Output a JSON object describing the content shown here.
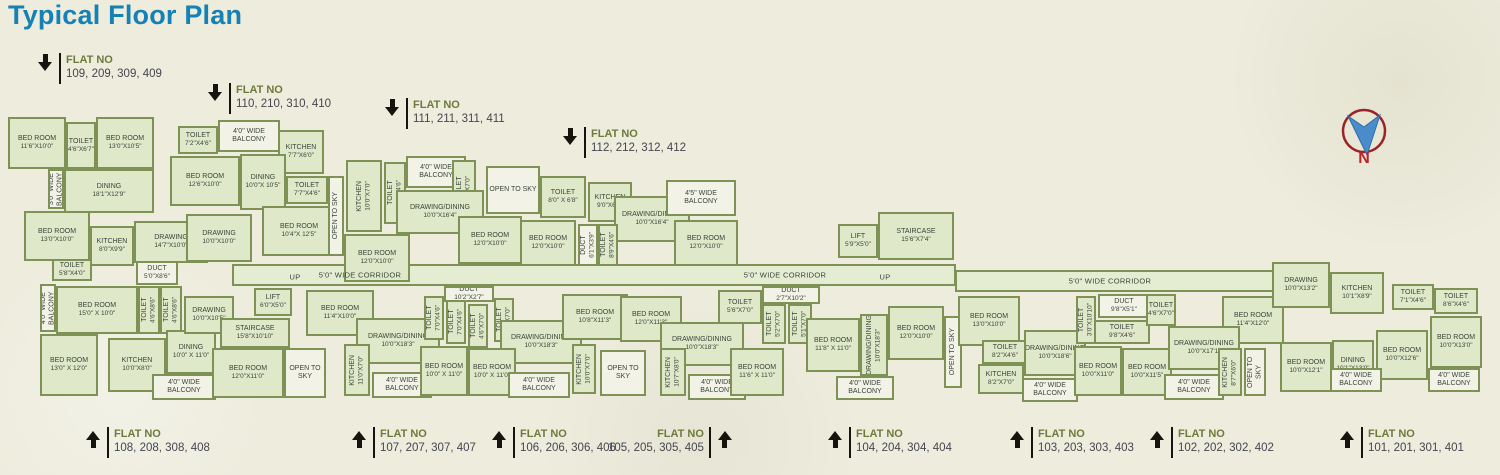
{
  "title": "Typical Floor Plan",
  "compass": {
    "north_label": "N"
  },
  "colors": {
    "title": "#1581b4",
    "wall": "#7e9255",
    "room_fill": "#dfe8c9",
    "light_fill": "#f3f2e6",
    "flat_no_text": "#6d7b3c",
    "flat_numbers_text": "#45464f",
    "compass_ring": "#9b2226",
    "compass_needle": "#4a8ccb",
    "compass_n": "#b9252b"
  },
  "flat_labels": {
    "heading": "FLAT NO",
    "top": [
      {
        "x": 38,
        "y": 53,
        "numbers": "109, 209, 309, 409"
      },
      {
        "x": 208,
        "y": 83,
        "numbers": "110, 210, 310, 410"
      },
      {
        "x": 385,
        "y": 98,
        "numbers": "111, 211, 311, 411"
      },
      {
        "x": 563,
        "y": 127,
        "numbers": "112, 212, 312, 412"
      }
    ],
    "bottom": [
      {
        "x": 86,
        "y": 427,
        "numbers": "108, 208, 308, 408"
      },
      {
        "x": 352,
        "y": 427,
        "numbers": "107, 207, 307, 407"
      },
      {
        "x": 492,
        "y": 427,
        "numbers": "106, 206, 306, 406"
      },
      {
        "x": 608,
        "y": 427,
        "numbers": "105, 205, 305, 405",
        "mirror": true
      },
      {
        "x": 828,
        "y": 427,
        "numbers": "104, 204, 304, 404"
      },
      {
        "x": 1010,
        "y": 427,
        "numbers": "103, 203, 303, 403"
      },
      {
        "x": 1150,
        "y": 427,
        "numbers": "102, 202, 302, 402"
      },
      {
        "x": 1340,
        "y": 427,
        "numbers": "101, 201, 301, 401"
      }
    ]
  },
  "plan": {
    "corridors": [
      {
        "x": 232,
        "y": 264,
        "w": 724,
        "h": 22
      },
      {
        "x": 955,
        "y": 270,
        "w": 320,
        "h": 22
      }
    ],
    "float_labels": [
      {
        "x": 360,
        "y": 275,
        "text": "5'0\" WIDE CORRIDOR"
      },
      {
        "x": 785,
        "y": 275,
        "text": "5'0\" WIDE CORRIDOR"
      },
      {
        "x": 1110,
        "y": 281,
        "text": "5'0\" WIDE CORRIDOR"
      },
      {
        "x": 295,
        "y": 277,
        "text": "UP"
      },
      {
        "x": 885,
        "y": 277,
        "text": "UP"
      }
    ],
    "rooms": [
      {
        "x": 8,
        "y": 117,
        "w": 58,
        "h": 52,
        "n": "BED ROOM",
        "d": "11'6\"X10'0\""
      },
      {
        "x": 66,
        "y": 122,
        "w": 30,
        "h": 47,
        "n": "TOILET",
        "d": "4'6\"X6'7\""
      },
      {
        "x": 96,
        "y": 117,
        "w": 58,
        "h": 52,
        "n": "BED ROOM",
        "d": "13'0\"X10'5\""
      },
      {
        "x": 48,
        "y": 169,
        "w": 16,
        "h": 40,
        "n": "3'0\" WIDE BALCONY",
        "v": true,
        "f": "w"
      },
      {
        "x": 64,
        "y": 169,
        "w": 90,
        "h": 44,
        "n": "DINING",
        "d": "18'1\"X12'9\""
      },
      {
        "x": 24,
        "y": 211,
        "w": 66,
        "h": 50,
        "n": "BED ROOM",
        "d": "13'0\"X10'0\""
      },
      {
        "x": 90,
        "y": 226,
        "w": 44,
        "h": 40,
        "n": "KITCHEN",
        "d": "8'0\"X9'9\""
      },
      {
        "x": 52,
        "y": 259,
        "w": 40,
        "h": 22,
        "n": "TOILET",
        "d": "5'8\"X4'0\""
      },
      {
        "x": 134,
        "y": 221,
        "w": 74,
        "h": 42,
        "n": "DRAWING",
        "d": "14'7\"X10'0\""
      },
      {
        "x": 136,
        "y": 261,
        "w": 42,
        "h": 24,
        "n": "DUCT",
        "d": "5'0\"X8'6\"",
        "f": "w"
      },
      {
        "x": 178,
        "y": 126,
        "w": 40,
        "h": 28,
        "n": "TOILET",
        "d": "7'2\"X4'6\""
      },
      {
        "x": 218,
        "y": 120,
        "w": 62,
        "h": 32,
        "n": "4'0\" WIDE BALCONY",
        "f": "w"
      },
      {
        "x": 278,
        "y": 130,
        "w": 46,
        "h": 44,
        "n": "KITCHEN",
        "d": "7'7\"X6'0\""
      },
      {
        "x": 170,
        "y": 156,
        "w": 70,
        "h": 50,
        "n": "BED ROOM",
        "d": "12'6\"X10'0\""
      },
      {
        "x": 240,
        "y": 154,
        "w": 46,
        "h": 56,
        "n": "DINING",
        "d": "10'0\"X 10'5\""
      },
      {
        "x": 286,
        "y": 176,
        "w": 42,
        "h": 28,
        "n": "TOILET",
        "d": "7'7\"X4'6\""
      },
      {
        "x": 262,
        "y": 206,
        "w": 74,
        "h": 50,
        "n": "BED ROOM",
        "d": "10'4\"X 12'5\""
      },
      {
        "x": 186,
        "y": 214,
        "w": 66,
        "h": 48,
        "n": "DRAWING",
        "d": "10'0\"X10'0\""
      },
      {
        "x": 328,
        "y": 176,
        "w": 16,
        "h": 80,
        "n": "OPEN TO SKY",
        "v": true,
        "f": "w"
      },
      {
        "x": 346,
        "y": 160,
        "w": 36,
        "h": 72,
        "n": "KITCHEN",
        "d": "10'0\"X7'0\"",
        "v": true
      },
      {
        "x": 384,
        "y": 162,
        "w": 22,
        "h": 62,
        "n": "TOILET",
        "d": "7'0\"X4'6\"",
        "v": true
      },
      {
        "x": 406,
        "y": 156,
        "w": 60,
        "h": 32,
        "n": "4'0\" WIDE BALCONY",
        "f": "w"
      },
      {
        "x": 452,
        "y": 160,
        "w": 24,
        "h": 58,
        "n": "TOILET",
        "d": "4'7\"X7'0\"",
        "v": true
      },
      {
        "x": 396,
        "y": 190,
        "w": 88,
        "h": 44,
        "n": "DRAWING/DINING",
        "d": "10'0\"X16'4\""
      },
      {
        "x": 344,
        "y": 234,
        "w": 66,
        "h": 48,
        "n": "BED ROOM",
        "d": "12'0\"X10'0\""
      },
      {
        "x": 458,
        "y": 216,
        "w": 64,
        "h": 48,
        "n": "BED ROOM",
        "d": "12'0\"X10'0\""
      },
      {
        "x": 486,
        "y": 166,
        "w": 54,
        "h": 48,
        "n": "OPEN TO SKY",
        "f": "w"
      },
      {
        "x": 540,
        "y": 176,
        "w": 46,
        "h": 42,
        "n": "TOILET",
        "d": "8'0\" X 6'8\""
      },
      {
        "x": 588,
        "y": 182,
        "w": 44,
        "h": 40,
        "n": "KITCHEN",
        "d": "9'0\"X6'0\""
      },
      {
        "x": 614,
        "y": 196,
        "w": 76,
        "h": 46,
        "n": "DRAWING/DINING",
        "d": "10'0\"X16'4\""
      },
      {
        "x": 520,
        "y": 220,
        "w": 56,
        "h": 46,
        "n": "BED ROOM",
        "d": "12'0\"X10'0\""
      },
      {
        "x": 578,
        "y": 224,
        "w": 20,
        "h": 42,
        "n": "DUCT",
        "d": "6'1\"X3'9\"",
        "v": true,
        "f": "w"
      },
      {
        "x": 598,
        "y": 224,
        "w": 20,
        "h": 42,
        "n": "TOILET",
        "d": "8'9\"X4'6\"",
        "v": true
      },
      {
        "x": 666,
        "y": 180,
        "w": 70,
        "h": 36,
        "n": "4'5\" WIDE BALCONY",
        "f": "w"
      },
      {
        "x": 674,
        "y": 220,
        "w": 64,
        "h": 46,
        "n": "BED ROOM",
        "d": "12'0\"X10'0\""
      },
      {
        "x": 838,
        "y": 224,
        "w": 40,
        "h": 34,
        "n": "LIFT",
        "d": "5'9\"X5'0\""
      },
      {
        "x": 878,
        "y": 212,
        "w": 76,
        "h": 48,
        "n": "STAIRCASE",
        "d": "15'6\"X7'4\""
      },
      {
        "x": 762,
        "y": 286,
        "w": 58,
        "h": 18,
        "n": "DUCT",
        "d": "2'7\"X10'2\"",
        "f": "w"
      },
      {
        "x": 40,
        "y": 284,
        "w": 16,
        "h": 48,
        "n": "4'0\" WIDE BALCONY",
        "v": true,
        "f": "w"
      },
      {
        "x": 56,
        "y": 286,
        "w": 82,
        "h": 48,
        "n": "BED ROOM",
        "d": "15'0\" X 10'0\""
      },
      {
        "x": 138,
        "y": 286,
        "w": 22,
        "h": 48,
        "n": "TOILET",
        "d": "4'6\"X8'6\"",
        "v": true
      },
      {
        "x": 160,
        "y": 286,
        "w": 22,
        "h": 48,
        "n": "TOILET",
        "d": "4'6\"X8'6\"",
        "v": true
      },
      {
        "x": 40,
        "y": 334,
        "w": 58,
        "h": 62,
        "n": "BED ROOM",
        "d": "13'0\" X 12'0\""
      },
      {
        "x": 108,
        "y": 338,
        "w": 58,
        "h": 54,
        "n": "KITCHEN",
        "d": "10'0\"X8'0\""
      },
      {
        "x": 166,
        "y": 330,
        "w": 50,
        "h": 44,
        "n": "DINING",
        "d": "10'0\" X 11'0\""
      },
      {
        "x": 152,
        "y": 374,
        "w": 64,
        "h": 26,
        "n": "4'0\" WIDE BALCONY",
        "f": "w"
      },
      {
        "x": 184,
        "y": 296,
        "w": 50,
        "h": 38,
        "n": "DRAWING",
        "d": "10'0\"X10'5\""
      },
      {
        "x": 254,
        "y": 288,
        "w": 38,
        "h": 28,
        "n": "LIFT",
        "d": "6'0\"X5'0\""
      },
      {
        "x": 220,
        "y": 318,
        "w": 70,
        "h": 30,
        "n": "STAIRCASE",
        "d": "15'8\"X10'10\""
      },
      {
        "x": 212,
        "y": 348,
        "w": 72,
        "h": 50,
        "n": "BED ROOM",
        "d": "12'0\"X11'0\""
      },
      {
        "x": 284,
        "y": 348,
        "w": 42,
        "h": 50,
        "n": "OPEN TO SKY",
        "f": "w"
      },
      {
        "x": 306,
        "y": 290,
        "w": 68,
        "h": 46,
        "n": "BED ROOM",
        "d": "11'4\"X10'0\""
      },
      {
        "x": 356,
        "y": 318,
        "w": 84,
        "h": 46,
        "n": "DRAWING/DINING",
        "d": "10'0\"X18'3\""
      },
      {
        "x": 424,
        "y": 296,
        "w": 20,
        "h": 44,
        "n": "TOILET",
        "d": "7'0\"X4'6\"",
        "v": true
      },
      {
        "x": 446,
        "y": 300,
        "w": 20,
        "h": 44,
        "n": "TOILET",
        "d": "7'0\"X4'6\"",
        "v": true
      },
      {
        "x": 344,
        "y": 344,
        "w": 26,
        "h": 52,
        "n": "KITCHEN",
        "d": "11'0\"X7'0\"",
        "v": true
      },
      {
        "x": 372,
        "y": 372,
        "w": 60,
        "h": 26,
        "n": "4'0\" WIDE BALCONY",
        "f": "w"
      },
      {
        "x": 420,
        "y": 346,
        "w": 48,
        "h": 50,
        "n": "BED ROOM",
        "d": "10'0\" X 11'0\""
      },
      {
        "x": 444,
        "y": 286,
        "w": 50,
        "h": 16,
        "n": "DUCT",
        "d": "10'2\"X2'7\"",
        "f": "w"
      },
      {
        "x": 468,
        "y": 304,
        "w": 20,
        "h": 44,
        "n": "TOILET",
        "d": "4'6\"X7'0\"",
        "v": true
      },
      {
        "x": 494,
        "y": 298,
        "w": 20,
        "h": 44,
        "n": "TOILET",
        "d": "4'6\"X7'0\"",
        "v": true
      },
      {
        "x": 500,
        "y": 320,
        "w": 82,
        "h": 44,
        "n": "DRAWING/DINING",
        "d": "10'0\"X18'3\""
      },
      {
        "x": 562,
        "y": 294,
        "w": 66,
        "h": 46,
        "n": "BED ROOM",
        "d": "10'8\"X11'3\""
      },
      {
        "x": 468,
        "y": 348,
        "w": 48,
        "h": 48,
        "n": "BED ROOM",
        "d": "10'0\" X 11'0\""
      },
      {
        "x": 572,
        "y": 344,
        "w": 24,
        "h": 50,
        "n": "KITCHEN",
        "d": "10'0\"X7'0\"",
        "v": true
      },
      {
        "x": 508,
        "y": 372,
        "w": 62,
        "h": 26,
        "n": "4'0\" WIDE BALCONY",
        "f": "w"
      },
      {
        "x": 600,
        "y": 350,
        "w": 46,
        "h": 46,
        "n": "OPEN TO SKY",
        "f": "w"
      },
      {
        "x": 620,
        "y": 296,
        "w": 62,
        "h": 46,
        "n": "BED ROOM",
        "d": "12'0\"X11'3\""
      },
      {
        "x": 660,
        "y": 322,
        "w": 84,
        "h": 44,
        "n": "DRAWING/DINING",
        "d": "10'0\"X18'3\""
      },
      {
        "x": 718,
        "y": 290,
        "w": 44,
        "h": 34,
        "n": "TOILET",
        "d": "5'6\"X7'0\""
      },
      {
        "x": 660,
        "y": 348,
        "w": 26,
        "h": 48,
        "n": "KITCHEN",
        "d": "10'7\"X8'0\"",
        "v": true
      },
      {
        "x": 688,
        "y": 374,
        "w": 58,
        "h": 26,
        "n": "4'0\" WIDE BALCONY",
        "f": "w"
      },
      {
        "x": 730,
        "y": 348,
        "w": 54,
        "h": 48,
        "n": "BED ROOM",
        "d": "11'6\" X 11'0\""
      },
      {
        "x": 762,
        "y": 304,
        "w": 24,
        "h": 40,
        "n": "TOILET",
        "d": "5'2\"X7'0\"",
        "v": true
      },
      {
        "x": 788,
        "y": 304,
        "w": 24,
        "h": 40,
        "n": "TOILET",
        "d": "5'1\"X7'0\"",
        "v": true
      },
      {
        "x": 806,
        "y": 318,
        "w": 54,
        "h": 54,
        "n": "BED ROOM",
        "d": "11'8\" X 11'0\""
      },
      {
        "x": 860,
        "y": 314,
        "w": 28,
        "h": 62,
        "n": "DRAWING/DINING",
        "d": "10'0\"X18'3\"",
        "v": true
      },
      {
        "x": 836,
        "y": 376,
        "w": 58,
        "h": 24,
        "n": "4'0\" WIDE BALCONY",
        "f": "w"
      },
      {
        "x": 888,
        "y": 306,
        "w": 56,
        "h": 54,
        "n": "BED ROOM",
        "d": "12'0\"X10'0\""
      },
      {
        "x": 944,
        "y": 316,
        "w": 18,
        "h": 72,
        "n": "OPEN TO SKY",
        "v": true,
        "f": "w"
      },
      {
        "x": 958,
        "y": 296,
        "w": 62,
        "h": 50,
        "n": "BED ROOM",
        "d": "13'0\"X10'0\""
      },
      {
        "x": 982,
        "y": 340,
        "w": 46,
        "h": 24,
        "n": "TOILET",
        "d": "8'2\"X4'6\""
      },
      {
        "x": 978,
        "y": 364,
        "w": 46,
        "h": 30,
        "n": "KITCHEN",
        "d": "8'2\"X7'0\""
      },
      {
        "x": 1024,
        "y": 330,
        "w": 62,
        "h": 46,
        "n": "DRAWING/DINING",
        "d": "10'0\"X18'6\""
      },
      {
        "x": 1022,
        "y": 378,
        "w": 56,
        "h": 24,
        "n": "4'0\" WIDE BALCONY",
        "f": "w"
      },
      {
        "x": 1076,
        "y": 296,
        "w": 20,
        "h": 48,
        "n": "TOILET",
        "d": "3'0\"X10'10\"",
        "v": true
      },
      {
        "x": 1098,
        "y": 294,
        "w": 52,
        "h": 24,
        "n": "DUCT",
        "d": "9'8\"X5'1\"",
        "f": "w"
      },
      {
        "x": 1094,
        "y": 320,
        "w": 56,
        "h": 24,
        "n": "TOILET",
        "d": "9'8\"X4'6\""
      },
      {
        "x": 1074,
        "y": 346,
        "w": 48,
        "h": 50,
        "n": "BED ROOM",
        "d": "10'0\"X11'0\""
      },
      {
        "x": 1146,
        "y": 294,
        "w": 30,
        "h": 32,
        "n": "TOILET",
        "d": "4'6\"X7'0\""
      },
      {
        "x": 1122,
        "y": 348,
        "w": 50,
        "h": 48,
        "n": "BED ROOM",
        "d": "10'0\"X11'5\""
      },
      {
        "x": 1222,
        "y": 296,
        "w": 62,
        "h": 48,
        "n": "BED ROOM",
        "d": "11'4\"X12'0\""
      },
      {
        "x": 1168,
        "y": 326,
        "w": 72,
        "h": 44,
        "n": "DRAWING/DINING",
        "d": "10'0\"X17'1\""
      },
      {
        "x": 1164,
        "y": 374,
        "w": 60,
        "h": 26,
        "n": "4'0\" WIDE BALCONY",
        "f": "w"
      },
      {
        "x": 1218,
        "y": 348,
        "w": 24,
        "h": 48,
        "n": "KITCHEN",
        "d": "8'7\"X6'0\"",
        "v": true
      },
      {
        "x": 1244,
        "y": 348,
        "w": 22,
        "h": 48,
        "n": "OPEN TO SKY",
        "v": true,
        "f": "w"
      },
      {
        "x": 1272,
        "y": 262,
        "w": 58,
        "h": 46,
        "n": "DRAWING",
        "d": "10'0\"X13'2\""
      },
      {
        "x": 1330,
        "y": 272,
        "w": 54,
        "h": 42,
        "n": "KITCHEN",
        "d": "10'1\"X8'9\""
      },
      {
        "x": 1392,
        "y": 284,
        "w": 42,
        "h": 26,
        "n": "TOILET",
        "d": "7'1\"X4'6\""
      },
      {
        "x": 1434,
        "y": 288,
        "w": 44,
        "h": 26,
        "n": "TOILET",
        "d": "8'6\"X4'6\""
      },
      {
        "x": 1280,
        "y": 342,
        "w": 52,
        "h": 50,
        "n": "BED ROOM",
        "d": "10'0\"X12'1\""
      },
      {
        "x": 1332,
        "y": 340,
        "w": 42,
        "h": 50,
        "n": "DINING",
        "d": "10'1\"X13'0\""
      },
      {
        "x": 1376,
        "y": 330,
        "w": 52,
        "h": 50,
        "n": "BED ROOM",
        "d": "10'0\"X12'6\""
      },
      {
        "x": 1430,
        "y": 316,
        "w": 52,
        "h": 52,
        "n": "BED ROOM",
        "d": "10'0\"X13'0\""
      },
      {
        "x": 1330,
        "y": 368,
        "w": 52,
        "h": 24,
        "n": "4'0\" WIDE BALCONY",
        "f": "w"
      },
      {
        "x": 1428,
        "y": 368,
        "w": 52,
        "h": 24,
        "n": "4'0\" WIDE BALCONY",
        "f": "w"
      }
    ]
  }
}
